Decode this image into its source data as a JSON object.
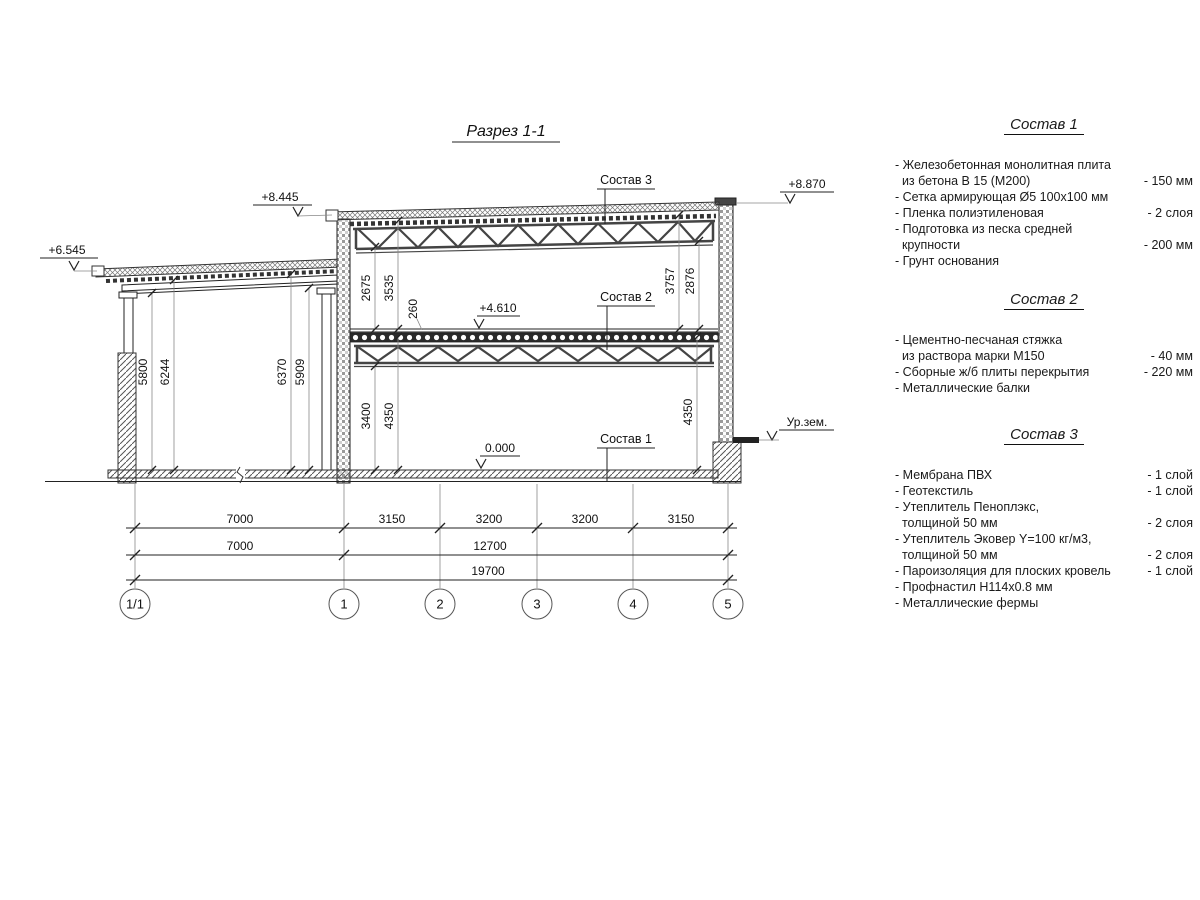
{
  "title": "Разрез 1-1",
  "callouts": {
    "c1": "Состав 1",
    "c2": "Состав 2",
    "c3": "Состав 3"
  },
  "elevations": {
    "roof_main": "+8.445",
    "roof_annex": "+6.545",
    "parapet": "+8.870",
    "floor2": "+4.610",
    "floor0": "0.000",
    "ground": "Ур.зем."
  },
  "dims": {
    "v_left": [
      "5800",
      "6244",
      "6370",
      "5909"
    ],
    "v_mid": [
      "2675",
      "3535",
      "260",
      "3400",
      "4350"
    ],
    "v_right": [
      "3757",
      "2876",
      "4350"
    ],
    "row1": [
      "7000",
      "3150",
      "3200",
      "3200",
      "3150"
    ],
    "row2": [
      "7000",
      "12700"
    ],
    "row3": [
      "19700"
    ]
  },
  "axes": [
    "1/1",
    "1",
    "2",
    "3",
    "4",
    "5"
  ],
  "panels": [
    {
      "heading": "Состав 1",
      "items": [
        {
          "t": "- Железобетонная  монолитная плита\n  из бетона В 15 (М200)",
          "v": "- 150 мм"
        },
        {
          "t": "- Сетка армирующая Ø5 100x100 мм"
        },
        {
          "t": "- Пленка полиэтиленовая",
          "v": "- 2 слоя"
        },
        {
          "t": "- Подготовка из песка средней\n  крупности",
          "v": "- 200 мм"
        },
        {
          "t": "- Грунт основания"
        }
      ]
    },
    {
      "heading": "Состав 2",
      "items": [
        {
          "t": "- Цементно-песчаная стяжка\n  из раствора марки М150",
          "v": "- 40 мм"
        },
        {
          "t": "- Сборные ж/б плиты перекрытия",
          "v": "- 220 мм"
        },
        {
          "t": "- Металлические балки"
        }
      ]
    },
    {
      "heading": "Состав 3",
      "items": [
        {
          "t": "- Мембрана ПВХ",
          "v": "- 1 слой"
        },
        {
          "t": "- Геотекстиль",
          "v": "- 1 слой"
        },
        {
          "t": "- Утеплитель Пеноплэкс,\n  толщиной 50 мм",
          "v": "- 2 слоя"
        },
        {
          "t": "- Утеплитель Эковер Y=100 кг/м3,\n  толщиной 50 мм",
          "v": "- 2 слоя"
        },
        {
          "t": "- Пароизоляция для плоских кровель",
          "v": "- 1 слой"
        },
        {
          "t": "- Профнастил Н114х0.8 мм"
        },
        {
          "t": "- Металлические фермы"
        }
      ]
    }
  ]
}
